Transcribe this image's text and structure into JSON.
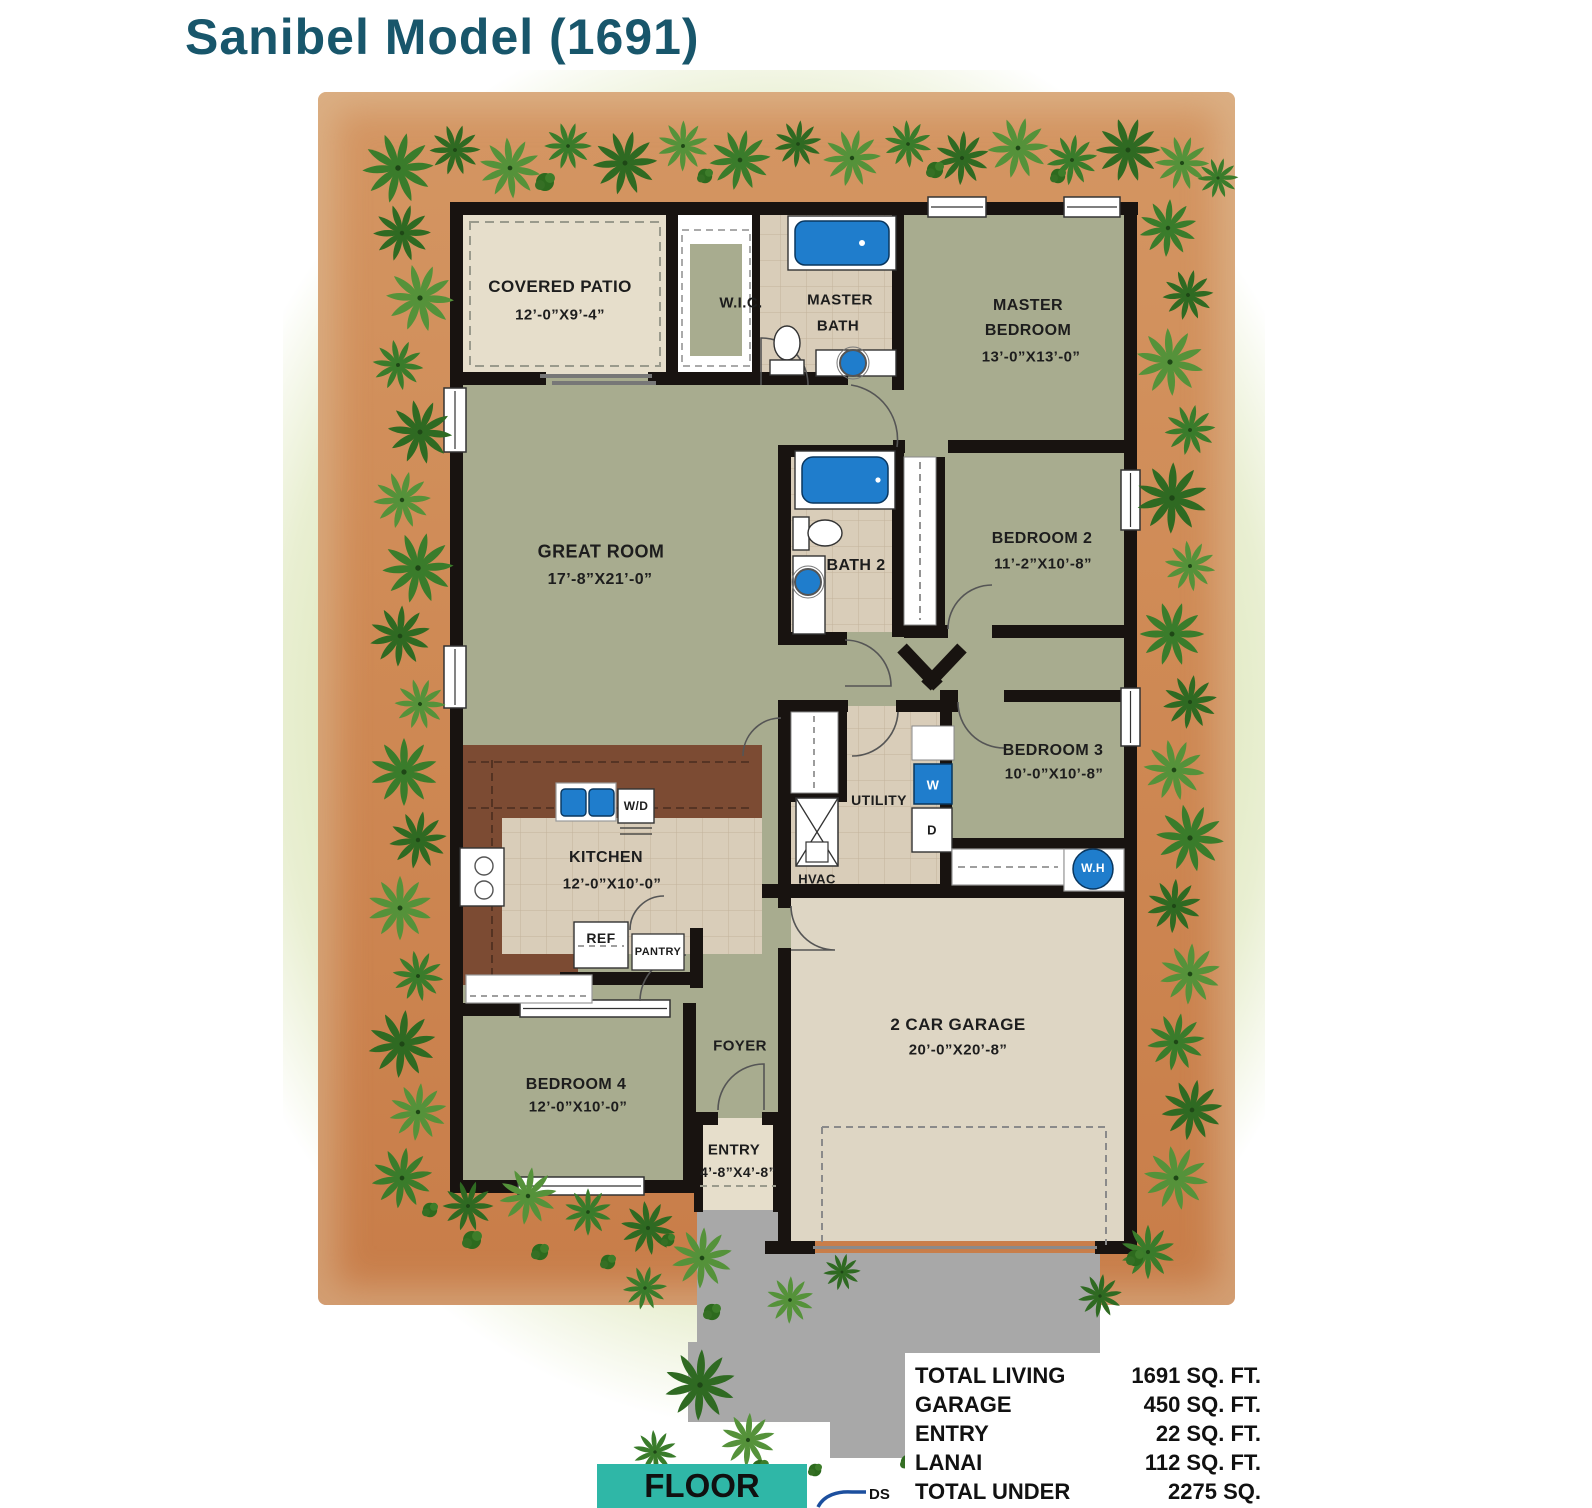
{
  "page": {
    "title": "Sanibel Model (1691)",
    "plan_label": "FLOOR PLAN",
    "ds_label": "DS"
  },
  "rooms": {
    "covered_patio": {
      "name": "COVERED PATIO",
      "dims": "12’-0”X9’-4”"
    },
    "wic": {
      "name": "W.I.C."
    },
    "master_bath": {
      "line1": "MASTER",
      "line2": "BATH"
    },
    "master_bedroom": {
      "line1": "MASTER",
      "line2": "BEDROOM",
      "dims": "13’-0”X13’-0”"
    },
    "great_room": {
      "name": "GREAT ROOM",
      "dims": "17’-8”X21’-0”"
    },
    "bath2": {
      "name": "BATH 2"
    },
    "bedroom2": {
      "name": "BEDROOM 2",
      "dims": "11’-2”X10’-8”"
    },
    "bedroom3": {
      "name": "BEDROOM 3",
      "dims": "10’-0”X10’-8”"
    },
    "utility": {
      "name": "UTILITY"
    },
    "hvac": {
      "name": "HVAC"
    },
    "kitchen": {
      "name": "KITCHEN",
      "dims": "12’-0”X10’-0”"
    },
    "bedroom4": {
      "name": "BEDROOM 4",
      "dims": "12’-0”X10’-0”"
    },
    "foyer": {
      "name": "FOYER"
    },
    "entry": {
      "name": "ENTRY",
      "dims": "4’-8”X4’-8”"
    },
    "garage": {
      "name": "2 CAR GARAGE",
      "dims": "20’-0”X20’-8”"
    }
  },
  "appliances": {
    "washer": "W",
    "dryer": "D",
    "water_heater": "W.H",
    "dishwasher": "W/D",
    "refrigerator": "REF",
    "pantry": "PANTRY"
  },
  "summary": {
    "rows": [
      {
        "label": "TOTAL LIVING",
        "value": "1691 SQ. FT."
      },
      {
        "label": "GARAGE",
        "value": "450 SQ. FT."
      },
      {
        "label": "ENTRY",
        "value": "22 SQ. FT."
      },
      {
        "label": "LANAI",
        "value": "112 SQ. FT."
      },
      {
        "label": "TOTAL UNDER ROOF",
        "value": "2275 SQ. FT."
      }
    ]
  },
  "colors": {
    "title_teal": "#18566b",
    "badge_teal": "#2fb7a7",
    "fixture_blue": "#1f7dcc",
    "wall_black": "#181310",
    "room_olive": "#a8ac8f",
    "tile_beige": "#d9cdb9",
    "patio_beige": "#e6decb",
    "garage_beige": "#ded6c4",
    "counter_brown": "#7c4b33",
    "driveway_gray": "#a8a8a8",
    "dirt_orange": "#cf8a55",
    "lawn_green": "#ccdc9e",
    "ds_line_blue": "#1c4f9e"
  },
  "icons": {
    "palm_tree": "star-burst palm frond cluster",
    "bush": "round shrub cluster",
    "hvac_unit": "box with X",
    "water_heater": "blue circle",
    "downspout_line": "blue curved line"
  }
}
